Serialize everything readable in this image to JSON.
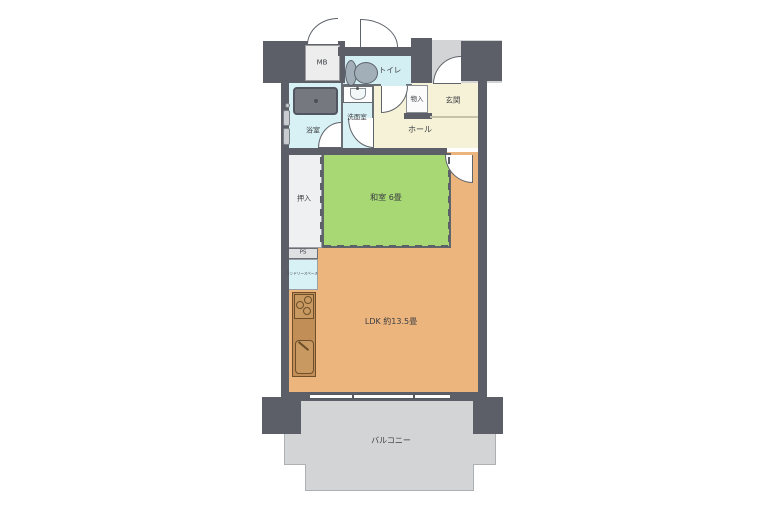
{
  "rooms": {
    "mb": {
      "label": "MB"
    },
    "toilet": {
      "label": "トイレ"
    },
    "storage": {
      "label": "物入"
    },
    "entrance": {
      "label": "玄関"
    },
    "bathroom": {
      "label": "浴室"
    },
    "washroom": {
      "label": "洗面室"
    },
    "hall": {
      "label": "ホール"
    },
    "closet": {
      "label": "押入"
    },
    "japanese_room": {
      "label": "和室 6畳"
    },
    "pipe_space": {
      "label": "PS"
    },
    "laundry": {
      "label": "ランドリースペース"
    },
    "ldk": {
      "label": "LDK 約13.5畳"
    },
    "balcony": {
      "label": "バルコニー"
    }
  },
  "colors": {
    "wall": "#5c5f67",
    "tatami_green": "#a7d873",
    "ldk_orange": "#ecb57d",
    "wet_area_blue": "#d8f1f4",
    "hall_cream": "#f6f2d7",
    "exterior_gray": "#d3d4d6",
    "kitchen_brown": "#c18e58",
    "bathtub_gray": "#75797f"
  }
}
